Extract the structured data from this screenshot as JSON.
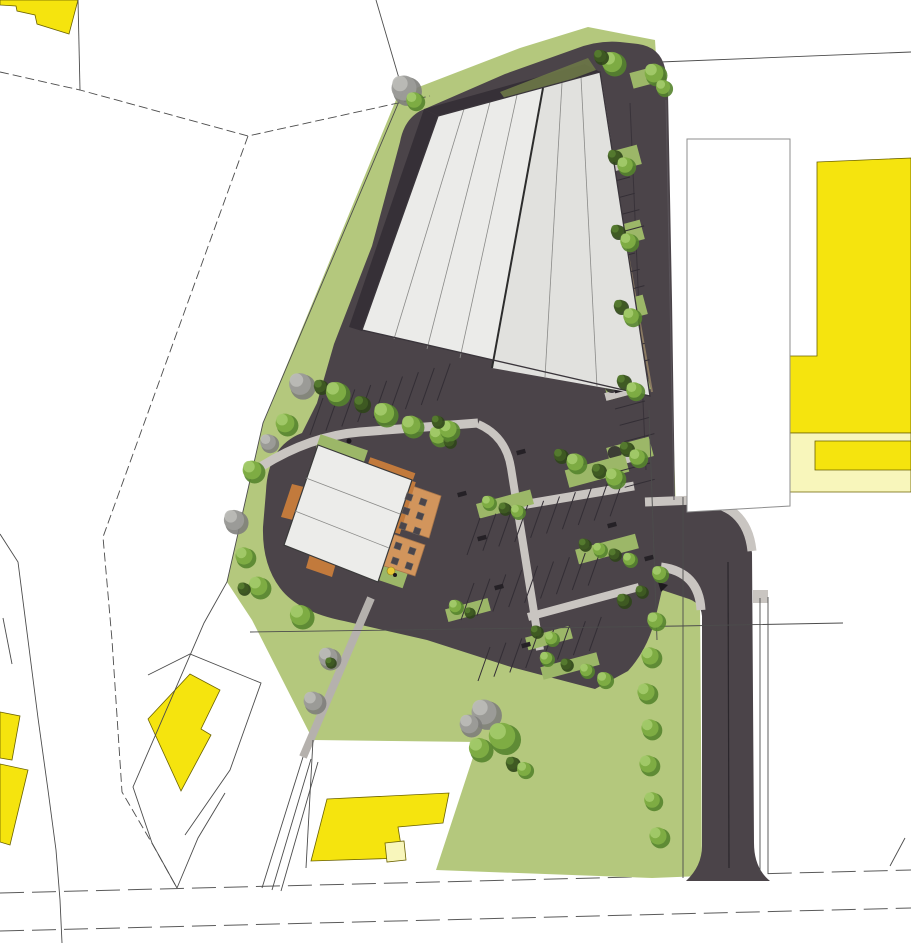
{
  "scene": {
    "type": "architectural-site-plan",
    "canvas_width": 911,
    "canvas_height": 943
  },
  "colors": {
    "page_bg": "#ffffff",
    "grass": "#b4c87d",
    "grass_island": "#9cb768",
    "asphalt": "#4b4449",
    "asphalt_shadow": "#363037",
    "olive_band": "#6d7847",
    "roof_main": "#ebebe9",
    "roof_secondary": "#e1e1de",
    "roof_small": "#ececea",
    "walk": "#c9c5c1",
    "walk_dark": "#b5b1ad",
    "yellow": "#f5e40e",
    "pale_yellow": "#f8f6bb",
    "orange": "#c27a3c",
    "terrace": "#d2955c",
    "stall_line": "#332e35",
    "parcel_line": "#4c4c4c",
    "outline_dark": "#3a353b",
    "centerline": "#2a262b",
    "table": "#4a454b",
    "tree_palettes": {
      "g": [
        "#55842e",
        "#7fae45",
        "#a4cb6b"
      ],
      "d": [
        "#2f4519",
        "#3f5b23",
        "#567c30"
      ],
      "x": [
        "#7e7e7b",
        "#9c9c99",
        "#bcbcb8"
      ]
    }
  },
  "site_features": {
    "trees": [
      [
        300,
        384,
        14,
        "x"
      ],
      [
        285,
        423,
        12,
        "g"
      ],
      [
        268,
        442,
        10,
        "x"
      ],
      [
        252,
        470,
        12,
        "g"
      ],
      [
        234,
        520,
        13,
        "x"
      ],
      [
        244,
        556,
        11,
        "g"
      ],
      [
        258,
        586,
        12,
        "g"
      ],
      [
        243,
        588,
        7,
        "d"
      ],
      [
        300,
        615,
        13,
        "g"
      ],
      [
        328,
        657,
        12,
        "x"
      ],
      [
        313,
        701,
        12,
        "x"
      ],
      [
        330,
        662,
        6,
        "d"
      ],
      [
        404,
        88,
        16,
        "x"
      ],
      [
        414,
        100,
        10,
        "g"
      ],
      [
        612,
        62,
        13,
        "g"
      ],
      [
        600,
        56,
        8,
        "d"
      ],
      [
        654,
        73,
        12,
        "g"
      ],
      [
        663,
        87,
        9,
        "g"
      ],
      [
        614,
        156,
        8,
        "d"
      ],
      [
        625,
        165,
        10,
        "g"
      ],
      [
        617,
        231,
        8,
        "d"
      ],
      [
        628,
        241,
        10,
        "g"
      ],
      [
        620,
        306,
        8,
        "d"
      ],
      [
        631,
        316,
        10,
        "g"
      ],
      [
        623,
        381,
        8,
        "d"
      ],
      [
        634,
        390,
        10,
        "g"
      ],
      [
        626,
        448,
        8,
        "d"
      ],
      [
        637,
        457,
        10,
        "g"
      ],
      [
        320,
        386,
        8,
        "d"
      ],
      [
        336,
        392,
        13,
        "g"
      ],
      [
        361,
        403,
        9,
        "d"
      ],
      [
        384,
        413,
        13,
        "g"
      ],
      [
        411,
        425,
        12,
        "g"
      ],
      [
        438,
        435,
        11,
        "g"
      ],
      [
        449,
        441,
        7,
        "d"
      ],
      [
        448,
        429,
        11,
        "g"
      ],
      [
        437,
        421,
        7,
        "d"
      ],
      [
        488,
        502,
        8,
        "g"
      ],
      [
        504,
        508,
        7,
        "d"
      ],
      [
        517,
        511,
        8,
        "g"
      ],
      [
        560,
        455,
        8,
        "d"
      ],
      [
        575,
        462,
        11,
        "g"
      ],
      [
        598,
        470,
        8,
        "d"
      ],
      [
        614,
        477,
        11,
        "g"
      ],
      [
        584,
        544,
        7,
        "d"
      ],
      [
        599,
        549,
        8,
        "g"
      ],
      [
        614,
        554,
        7,
        "d"
      ],
      [
        629,
        559,
        8,
        "g"
      ],
      [
        455,
        606,
        8,
        "g"
      ],
      [
        469,
        612,
        6,
        "d"
      ],
      [
        536,
        631,
        7,
        "d"
      ],
      [
        551,
        638,
        8,
        "g"
      ],
      [
        546,
        658,
        8,
        "g"
      ],
      [
        566,
        664,
        7,
        "d"
      ],
      [
        586,
        670,
        8,
        "g"
      ],
      [
        604,
        679,
        9,
        "g"
      ],
      [
        484,
        712,
        16,
        "x"
      ],
      [
        502,
        736,
        17,
        "g"
      ],
      [
        479,
        748,
        13,
        "g"
      ],
      [
        469,
        724,
        12,
        "x"
      ],
      [
        512,
        763,
        8,
        "d"
      ],
      [
        524,
        769,
        9,
        "g"
      ],
      [
        623,
        600,
        8,
        "d"
      ],
      [
        641,
        591,
        7,
        "d"
      ],
      [
        659,
        573,
        9,
        "g"
      ],
      [
        655,
        620,
        10,
        "g"
      ],
      [
        650,
        656,
        11,
        "g"
      ],
      [
        646,
        692,
        11,
        "g"
      ],
      [
        650,
        728,
        11,
        "g"
      ],
      [
        648,
        764,
        11,
        "g"
      ],
      [
        652,
        800,
        10,
        "g"
      ],
      [
        658,
        836,
        11,
        "g"
      ]
    ],
    "green_islands": [
      {
        "x": 618,
        "y": 160,
        "w": 44,
        "h": 20,
        "a": -15,
        "sh": 1
      },
      {
        "x": 621,
        "y": 235,
        "w": 44,
        "h": 20,
        "a": -15,
        "sh": 1
      },
      {
        "x": 624,
        "y": 310,
        "w": 44,
        "h": 20,
        "a": -15,
        "sh": 1
      },
      {
        "x": 627,
        "y": 385,
        "w": 44,
        "h": 20,
        "a": -15,
        "sh": 1
      },
      {
        "x": 630,
        "y": 452,
        "w": 44,
        "h": 20,
        "a": -15,
        "sh": 1
      },
      {
        "x": 597,
        "y": 471,
        "w": 62,
        "h": 18,
        "a": -15
      },
      {
        "x": 505,
        "y": 504,
        "w": 56,
        "h": 15,
        "a": -15
      },
      {
        "x": 607,
        "y": 549,
        "w": 62,
        "h": 15,
        "a": -15
      },
      {
        "x": 468,
        "y": 610,
        "w": 44,
        "h": 13,
        "a": -15
      },
      {
        "x": 549,
        "y": 638,
        "w": 46,
        "h": 13,
        "a": -15
      },
      {
        "x": 570,
        "y": 666,
        "w": 58,
        "h": 13,
        "a": -15
      },
      {
        "x": 646,
        "y": 77,
        "w": 30,
        "h": 16,
        "a": -15
      },
      {
        "x": 342,
        "y": 449,
        "w": 50,
        "h": 14,
        "a": 19
      },
      {
        "x": 392,
        "y": 573,
        "w": 30,
        "h": 22,
        "a": 19
      }
    ],
    "parking_stall_rows": [
      {
        "x": 323,
        "y": 398,
        "ux": 15.9,
        "uy": -4.3,
        "n": 9,
        "lx": -13,
        "ly": 37
      },
      {
        "x": 480,
        "y": 518,
        "ux": 15.9,
        "uy": -4.3,
        "n": 10,
        "lx": -13,
        "ly": 37
      },
      {
        "x": 474,
        "y": 583,
        "ux": 15.9,
        "uy": -4.3,
        "n": 9,
        "lx": -13,
        "ly": 37
      },
      {
        "x": 490,
        "y": 647,
        "ux": 15.9,
        "uy": -4.3,
        "n": 8,
        "lx": -12,
        "ly": 34
      },
      {
        "x": 600,
        "y": 185,
        "ux": 4.7,
        "uy": 16.3,
        "n": 4,
        "lx": 30,
        "ly": -8
      },
      {
        "x": 605,
        "y": 261,
        "ux": 4.7,
        "uy": 16.3,
        "n": 3,
        "lx": 30,
        "ly": -8
      },
      {
        "x": 610,
        "y": 335,
        "ux": 4.7,
        "uy": 16.3,
        "n": 3,
        "lx": 30,
        "ly": -8
      },
      {
        "x": 615,
        "y": 409,
        "ux": 4.7,
        "uy": 16.3,
        "n": 3,
        "lx": 30,
        "ly": -8
      },
      {
        "x": 620,
        "y": 471,
        "ux": 4.7,
        "uy": 16.3,
        "n": 2,
        "lx": 30,
        "ly": -8
      }
    ],
    "car_glyphs": [
      [
        521,
        452
      ],
      [
        462,
        494
      ],
      [
        482,
        538
      ],
      [
        499,
        587
      ],
      [
        526,
        645
      ],
      [
        612,
        240
      ],
      [
        616,
        316
      ],
      [
        619,
        390
      ],
      [
        612,
        525
      ],
      [
        649,
        558
      ]
    ],
    "tables": [
      [
        409,
        497
      ],
      [
        423,
        502
      ],
      [
        406,
        511
      ],
      [
        420,
        516
      ],
      [
        403,
        526
      ],
      [
        417,
        531
      ],
      [
        398,
        546
      ],
      [
        412,
        551
      ],
      [
        395,
        561
      ],
      [
        409,
        566
      ]
    ]
  }
}
